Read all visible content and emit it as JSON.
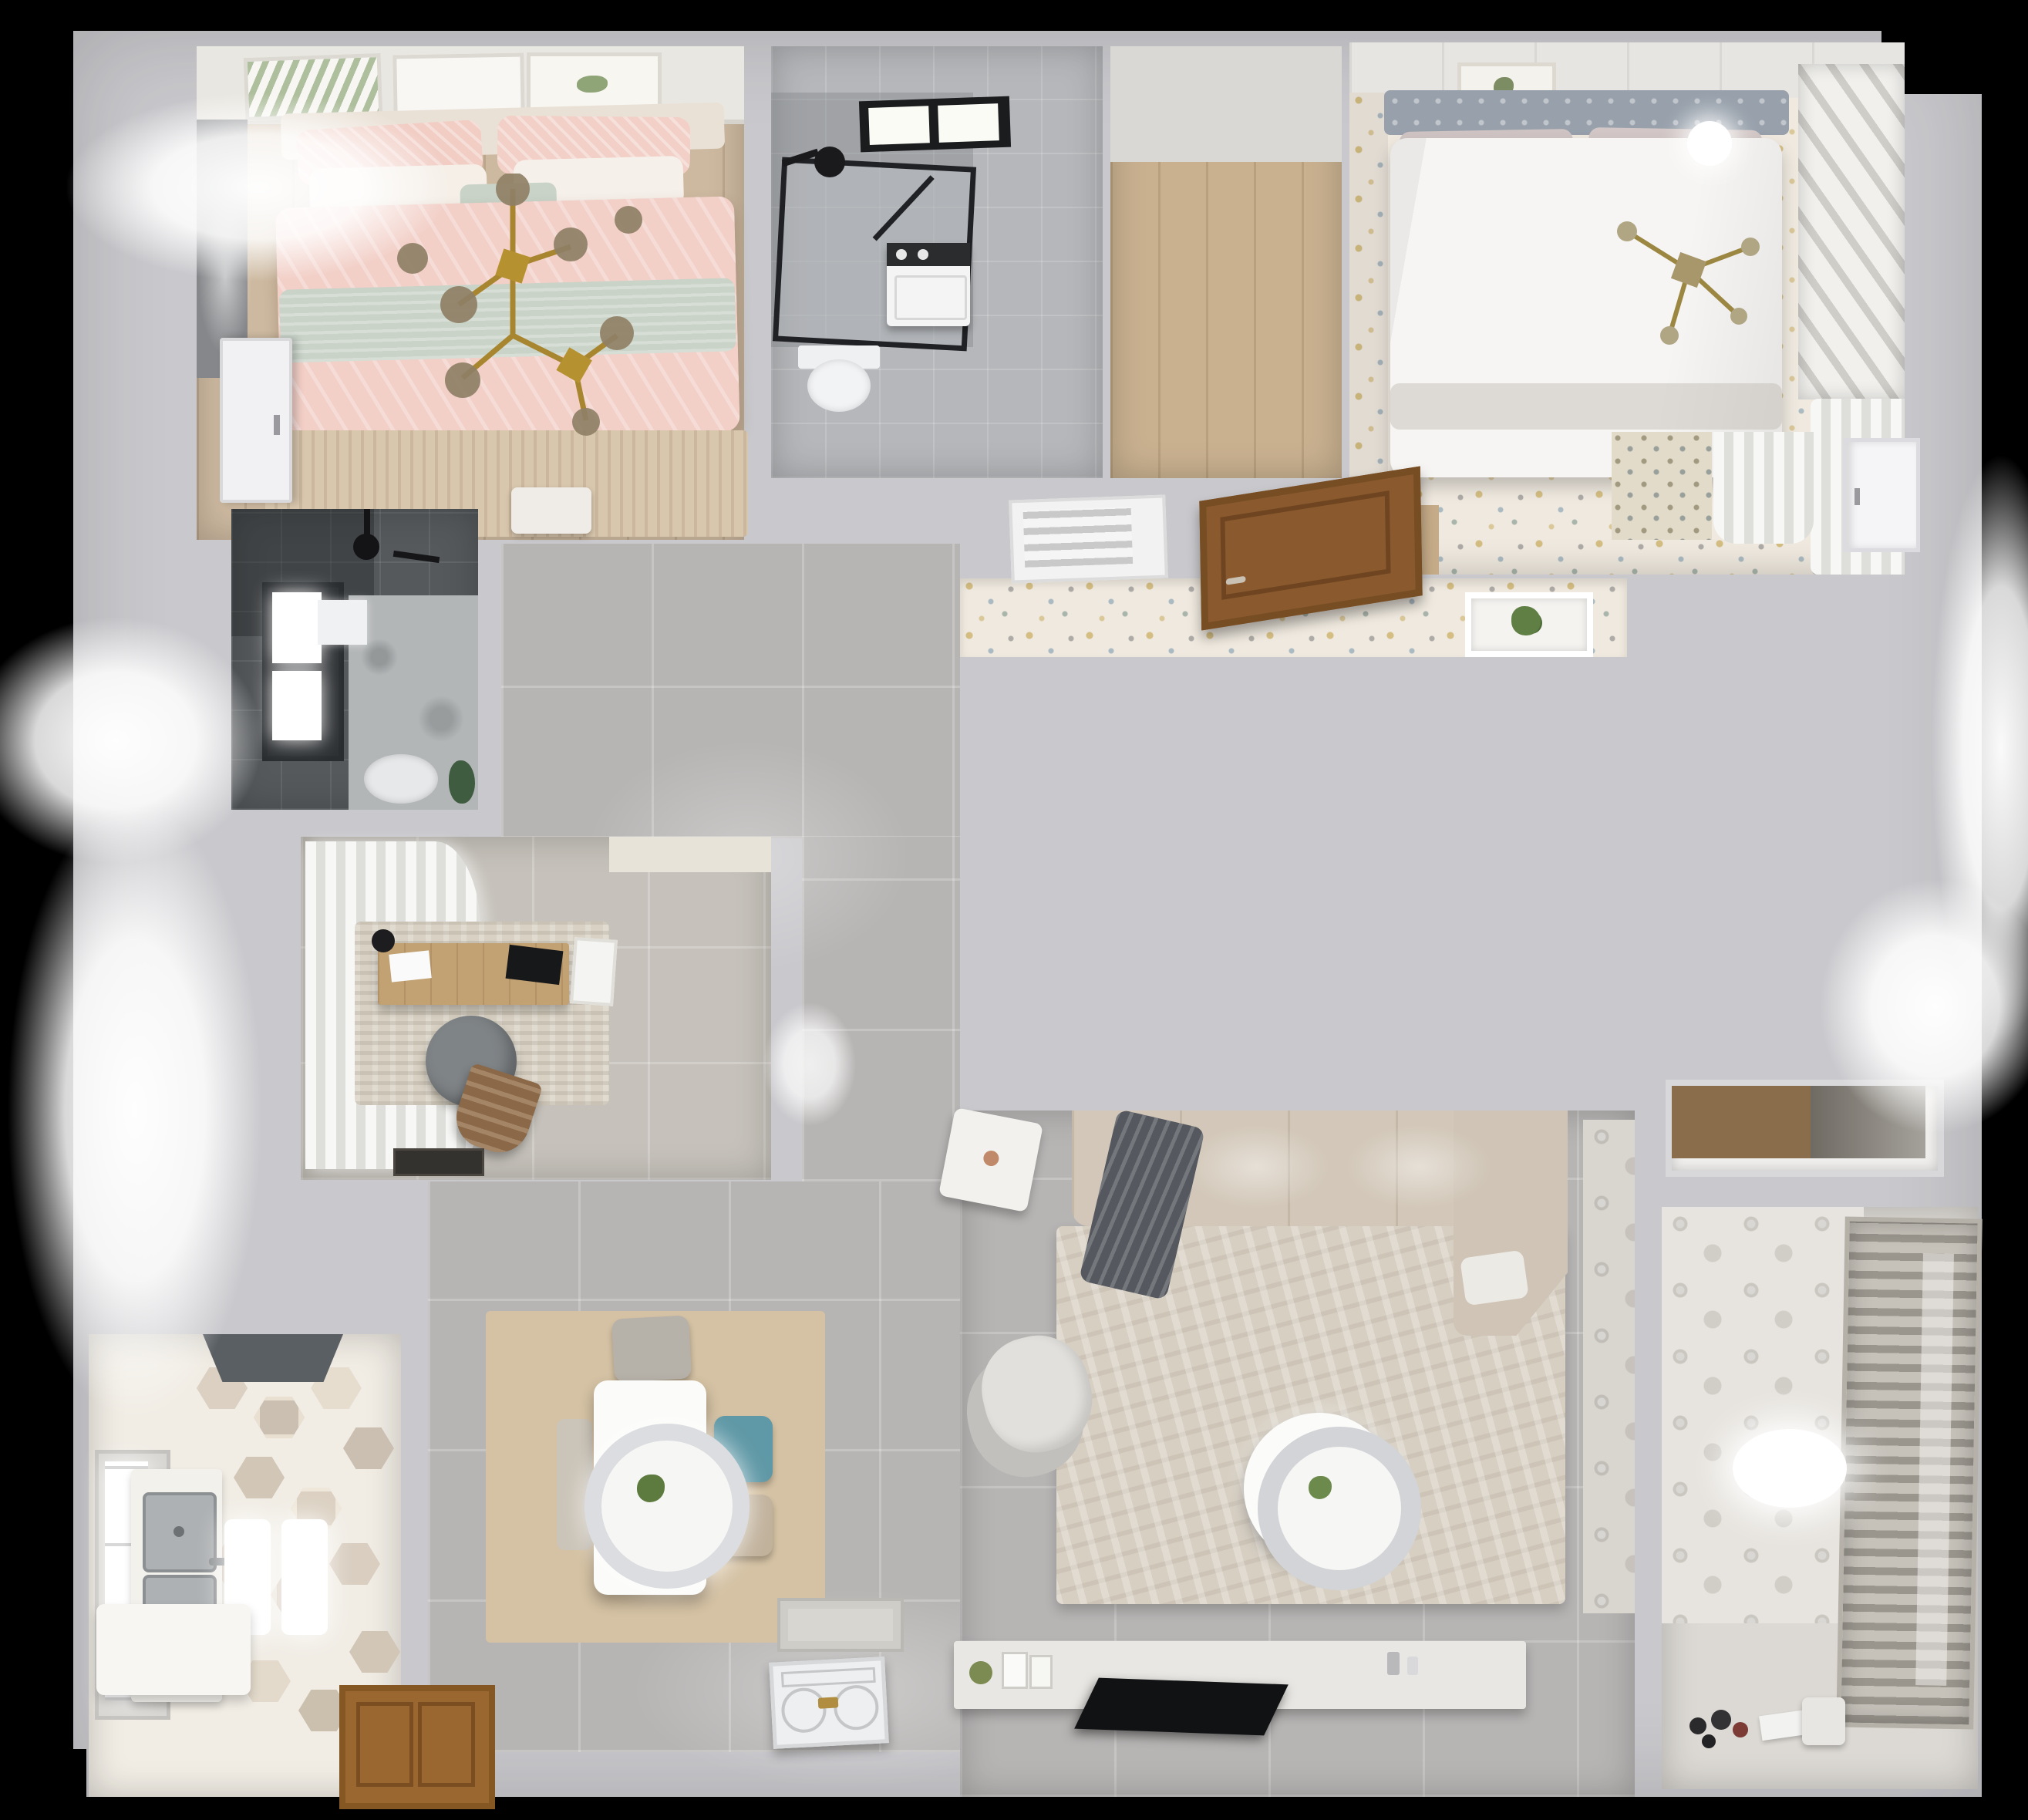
{
  "scene": {
    "title": "Top-down 3D cutaway render of a furnished apartment floor plan",
    "view": "top-down cutaway",
    "background": "#000000"
  },
  "palette": {
    "wall": "#c9c9cd",
    "wall-shadow": "#a8a8ac",
    "corridor-floor": "#b7b5b4",
    "wood-light": "#cdb9a0",
    "wood-mid": "#c9b190",
    "wood-door": "#8a5a2e",
    "pink-bed": "#f2cfc7",
    "sage-band": "#c9d3c8",
    "gold": "#a8862f",
    "dark-tile": "#55595c",
    "teal-chair": "#5f98a6",
    "blue-rug": "#8cb0d2",
    "mauve-rug": "#9b8388",
    "confetti-floor": "#efe9df",
    "sofa-beige": "#d2c7b8",
    "throw-gray": "#55595f",
    "tv-black": "#111214",
    "glow-white": "#ffffff"
  },
  "rooms": [
    {
      "id": "kids-bedroom",
      "name": "Kids bedroom with pink double bed",
      "furniture": [
        "gallery wall frames",
        "pink double bed",
        "white and sage pillows",
        "gold branch chandelier",
        "window with roman blind",
        "fringed area rug",
        "nightstand",
        "white door"
      ]
    },
    {
      "id": "top-bathroom",
      "name": "Bathroom with walk-in shower",
      "furniture": [
        "black framed skylight",
        "walk-in shower glass",
        "rain shower head",
        "washing machine",
        "toilet"
      ]
    },
    {
      "id": "closet-hall",
      "name": "Walk-in closet with wood floor",
      "furniture": [
        "wood plank flooring"
      ]
    },
    {
      "id": "master-bedroom",
      "name": "Master bedroom",
      "furniture": [
        "gray upholstered headboard",
        "white duvet bed",
        "art frame",
        "ceiling light",
        "gold chandelier",
        "louvered shutter wall",
        "sheer curtain",
        "plant niche"
      ]
    },
    {
      "id": "hallway",
      "name": "Hallway with patterned wallpaper",
      "furniture": [
        "air vent grille",
        "open wooden door",
        "confetti wallpaper band"
      ]
    },
    {
      "id": "shower-room",
      "name": "Dark tiled shower room",
      "furniture": [
        "bright window",
        "rain shower head",
        "mirror",
        "toilet",
        "green plant"
      ]
    },
    {
      "id": "study",
      "name": "Study with desk",
      "furniture": [
        "sheer curtain wall",
        "wooden desk",
        "monitor",
        "round desk chair",
        "leather lounge chair",
        "textured rug",
        "doormat"
      ]
    },
    {
      "id": "kitchen",
      "name": "Kitchen with hexagon tile floor",
      "furniture": [
        "range hood",
        "double stainless sink",
        "counter",
        "bright window",
        "white island",
        "ceiling light reflections",
        "wooden door"
      ]
    },
    {
      "id": "dining",
      "name": "Dining area",
      "furniture": [
        "white dining table",
        "ring pendant lamp with plant",
        "gray chair",
        "teal chair",
        "beige chair",
        "inner doormat"
      ]
    },
    {
      "id": "living-room",
      "name": "Living room",
      "furniture": [
        "corner sofa",
        "dark knit throw",
        "white side table",
        "round armchair",
        "ring coffee table",
        "area rug",
        "TV console",
        "flat TV on floor",
        "ornate front door"
      ]
    },
    {
      "id": "laundry-balcony",
      "name": "Laundry balcony",
      "furniture": [
        "roller blind window",
        "circle motif wallpaper",
        "oval ceiling lamp",
        "toys",
        "papers",
        "storage bin"
      ]
    },
    {
      "id": "storage-niche",
      "name": "Storage niche",
      "furniture": [
        "wood cabinet"
      ]
    }
  ]
}
